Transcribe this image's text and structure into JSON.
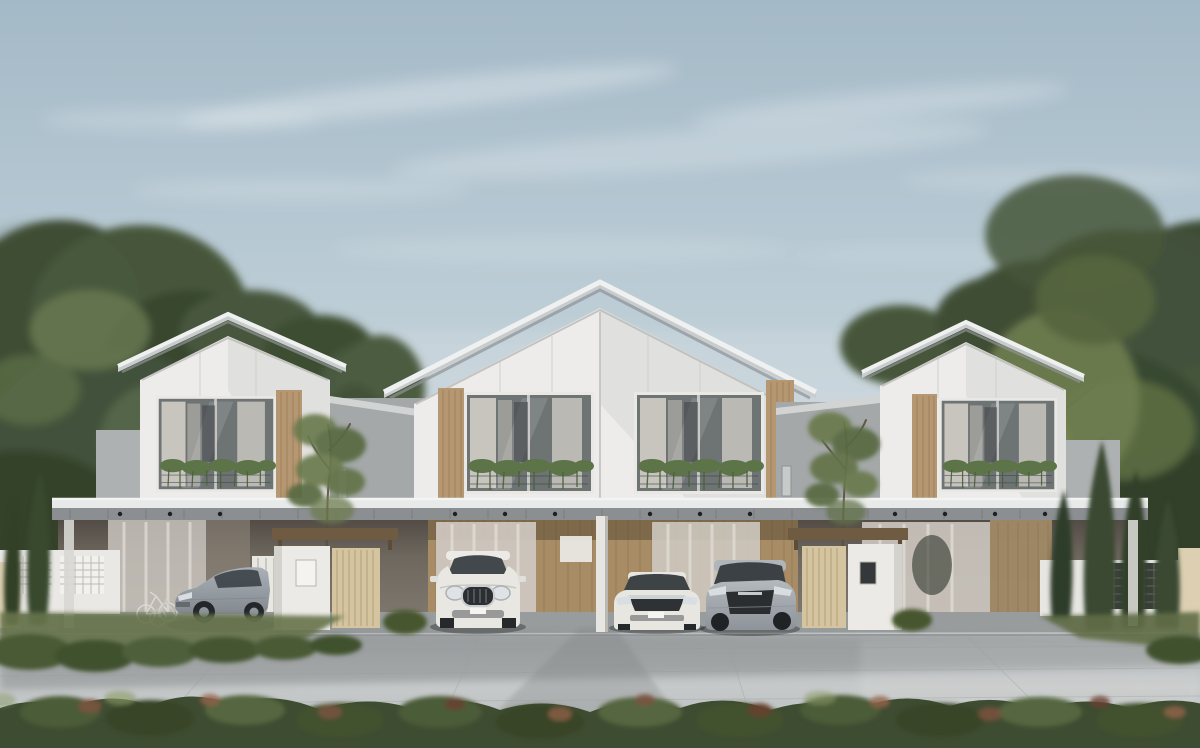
{
  "scene": {
    "description": "Photorealistic architectural rendering of three modern two-storey gabled townhouses with wood-accent balcony windows and hanging plants, a shared flat carport canopy sheltering four parked cars, timber entrance gates, dense trees on both sides, and a wide grey paved driveway with a red-tipped hedge in the foreground under a hazy blue sky.",
    "sky": {
      "condition": "hazy blue with wispy clouds"
    },
    "buildings": {
      "units": 3,
      "storeys": 2,
      "style": "modern gable townhouse"
    },
    "vehicles": [
      {
        "name": "silver-sedan",
        "body_color": "#a9b0b7"
      },
      {
        "name": "white-compact-suv",
        "body_color": "#e9e7e2"
      },
      {
        "name": "white-sedan",
        "body_color": "#e8e6e1"
      },
      {
        "name": "silver-crossover",
        "body_color": "#b4b9be"
      }
    ],
    "landscape": {
      "foreground": "hedge with red-tipped shrubs",
      "left": "dense trees, cypresses and white lattice fence",
      "right": "trees, cypresses and mesh fence panel"
    }
  },
  "colors": {
    "sky_top": "#a4b9c7",
    "sky_mid": "#bccdd6",
    "sky_horizon": "#cfd8db",
    "cloud": "#ffffff",
    "tree_dark": "#3c4a31",
    "tree_mid": "#51613d",
    "tree_light": "#6f7e4f",
    "roof_slab": "#c9cccd",
    "roof_fascia": "#eff1f1",
    "roof_under": "#8e9294",
    "wall_white": "#edecea",
    "wall_grey": "#a4a8a8",
    "wood_panel": "#b59772",
    "glass": "#6e7374",
    "curtain": "#d8d4cd",
    "planter_green": "#5c7447",
    "canopy_fascia": "#e8eaea",
    "canopy_under": "#8b8f92",
    "interior_wood": "#a78c66",
    "gate_wood": "#d5c4a0",
    "gate_white": "#eceae6",
    "pave_far": "#a2a6a7",
    "pave_near": "#c6c9c9",
    "pave_band": "#85898b",
    "hedge_green": "#3e4c31",
    "hedge_red": "#7d5340",
    "grass": "#66744a"
  }
}
